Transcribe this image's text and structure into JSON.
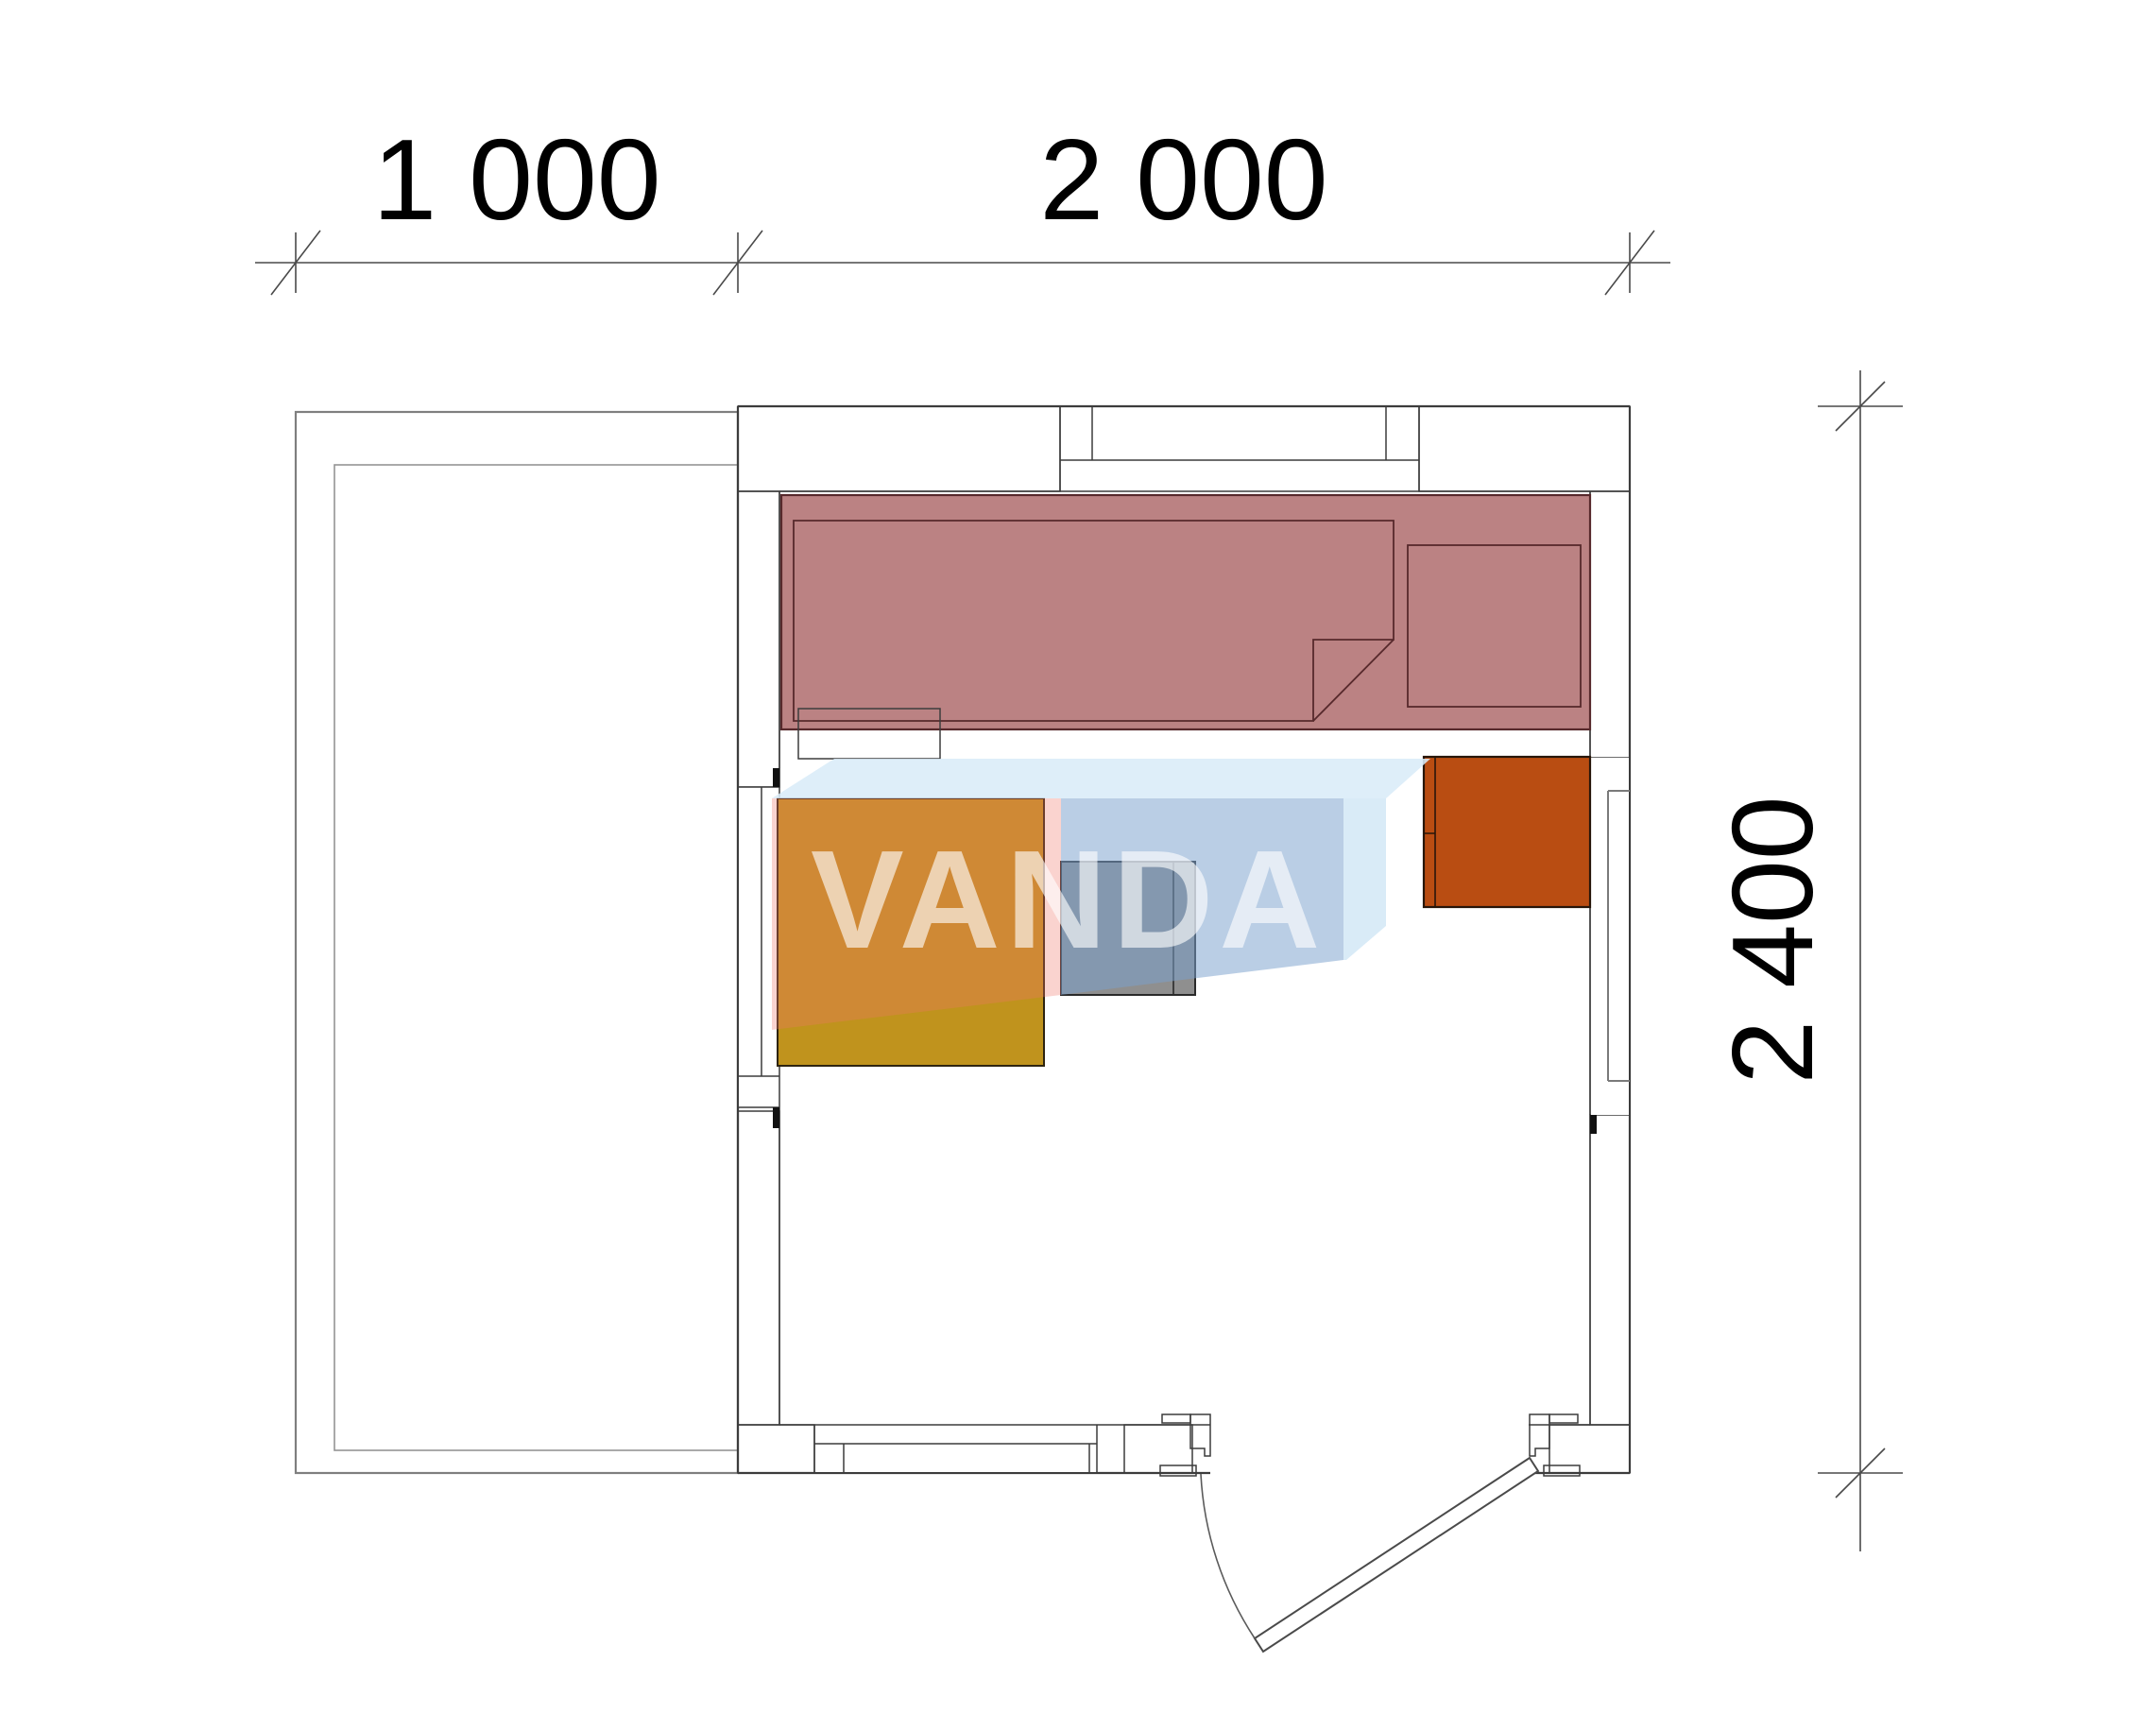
{
  "drawing": {
    "type": "architectural-floor-plan",
    "watermark": {
      "text": "VANDA"
    },
    "dimensions": {
      "top": [
        {
          "label": "1 000"
        },
        {
          "label": "2 000"
        }
      ],
      "right": [
        {
          "label": "2 400"
        }
      ]
    },
    "elements": [
      "terrace-outline",
      "exterior-walls-with-insulation-hatch",
      "window-top",
      "window-left",
      "window-right",
      "window-bottom",
      "bed-with-blanket-and-pillow",
      "bed-step",
      "table",
      "stove",
      "heater",
      "entry-door-with-swing-arc"
    ],
    "colors": {
      "wall_line": "#3c3c3c",
      "insulation_hatch": "#b5b55e",
      "bed_fill": "#bb8283",
      "table_fill": "#c0931d",
      "stove_fill": "#8f8f8f",
      "heater_fill": "#b94d12",
      "watermark_blue": "#aecbe5",
      "watermark_pink": "#f5c2cb",
      "dimension_text": "#000000"
    }
  }
}
